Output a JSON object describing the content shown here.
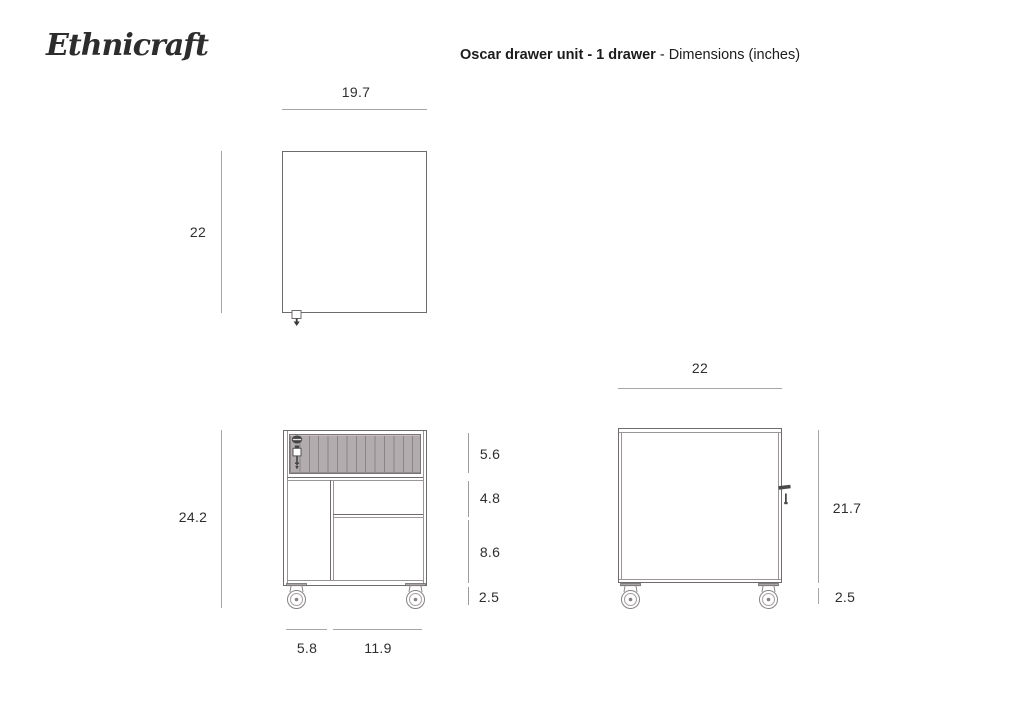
{
  "brand": "Ethnicraft",
  "title": {
    "product": "Oscar drawer unit - 1 drawer",
    "suffix": " - Dimensions (inches)"
  },
  "units": "inches",
  "colors": {
    "outline": "#6f6b6d",
    "dimension_line": "#a6a6a6",
    "text": "#2e2e2e",
    "drawer_slat_fill": "#b2acae",
    "drawer_slat_line": "#8b8587"
  },
  "icons": {
    "top_view_lock": "lock-plan-icon",
    "front_lock_and_key": "lock-key-icon",
    "side_key": "key-side-icon",
    "caster": "caster-wheel-icon"
  },
  "views": {
    "top": {
      "width": "19.7",
      "depth": "22"
    },
    "front": {
      "overall_height": "24.2",
      "drawer_height": "5.6",
      "upper_compartment_height": "4.8",
      "lower_compartment_height": "8.6",
      "caster_height": "2.5",
      "left_section_width": "5.8",
      "right_section_width": "11.9"
    },
    "side": {
      "depth": "22",
      "body_height": "21.7",
      "caster_height": "2.5"
    }
  }
}
